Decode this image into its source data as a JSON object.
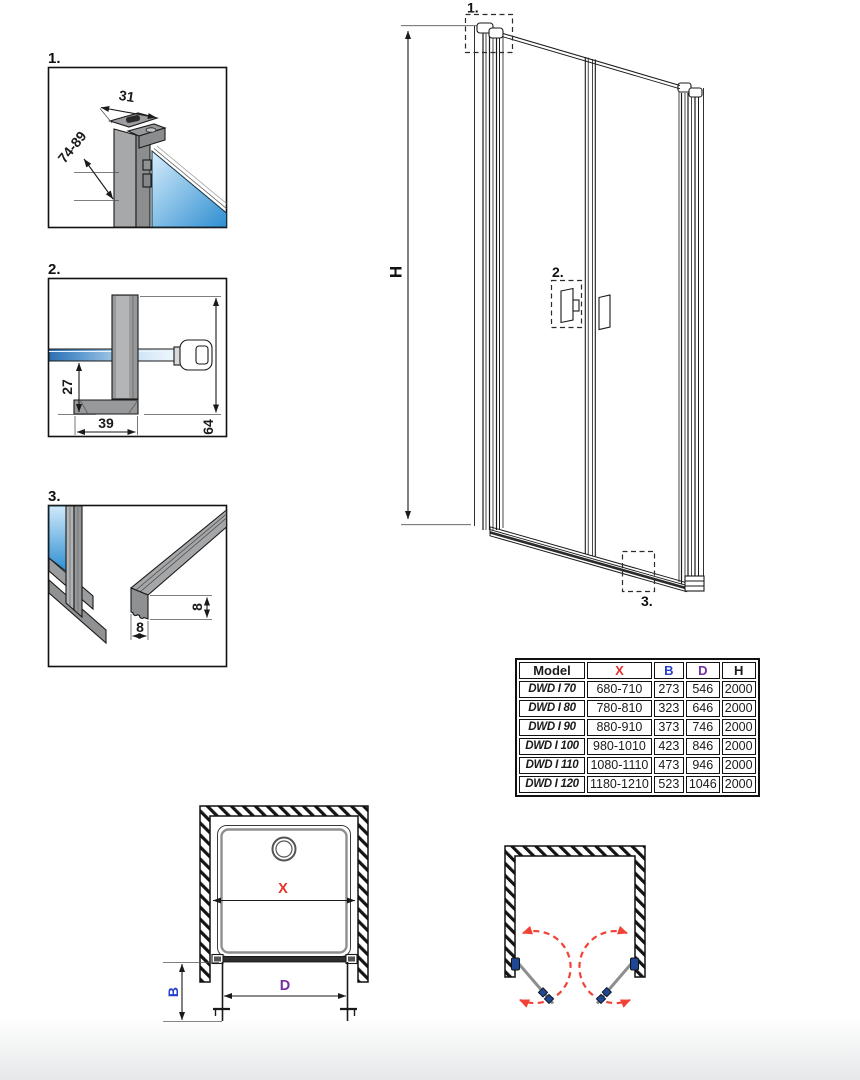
{
  "colors": {
    "dim_red": "#e8312a",
    "dim_blue": "#2640cc",
    "dim_purple": "#7430a0",
    "hinge_blue": "#1e4796",
    "swing_red": "#f04237",
    "glass_blue": "#2e8fd2",
    "line": "#1a1a1a"
  },
  "details": {
    "d1": {
      "label": "1.",
      "dim_width": "31",
      "dim_range": "74-89"
    },
    "d2": {
      "label": "2.",
      "dim_offset": "27",
      "dim_foot": "39",
      "dim_height": "64"
    },
    "d3": {
      "label": "3.",
      "dim_height": "8",
      "dim_width": "8"
    }
  },
  "elevation": {
    "height_label": "H",
    "callout_1": "1.",
    "callout_2": "2.",
    "callout_3": "3."
  },
  "plan": {
    "width_label": "X",
    "side_label": "B",
    "door_label": "D"
  },
  "table": {
    "headers": [
      "Model",
      "X",
      "B",
      "D",
      "H"
    ],
    "header_colors": [
      "#1a1a1a",
      "#e8312a",
      "#2640cc",
      "#7430a0",
      "#1a1a1a"
    ],
    "rows": [
      {
        "model": "DWD I 70",
        "x": "680-710",
        "b": "273",
        "d": "546",
        "h": "2000"
      },
      {
        "model": "DWD I 80",
        "x": "780-810",
        "b": "323",
        "d": "646",
        "h": "2000"
      },
      {
        "model": "DWD I 90",
        "x": "880-910",
        "b": "373",
        "d": "746",
        "h": "2000"
      },
      {
        "model": "DWD I 100",
        "x": "980-1010",
        "b": "423",
        "d": "846",
        "h": "2000"
      },
      {
        "model": "DWD I 110",
        "x": "1080-1110",
        "b": "473",
        "d": "946",
        "h": "2000"
      },
      {
        "model": "DWD I 120",
        "x": "1180-1210",
        "b": "523",
        "d": "1046",
        "h": "2000"
      }
    ]
  }
}
